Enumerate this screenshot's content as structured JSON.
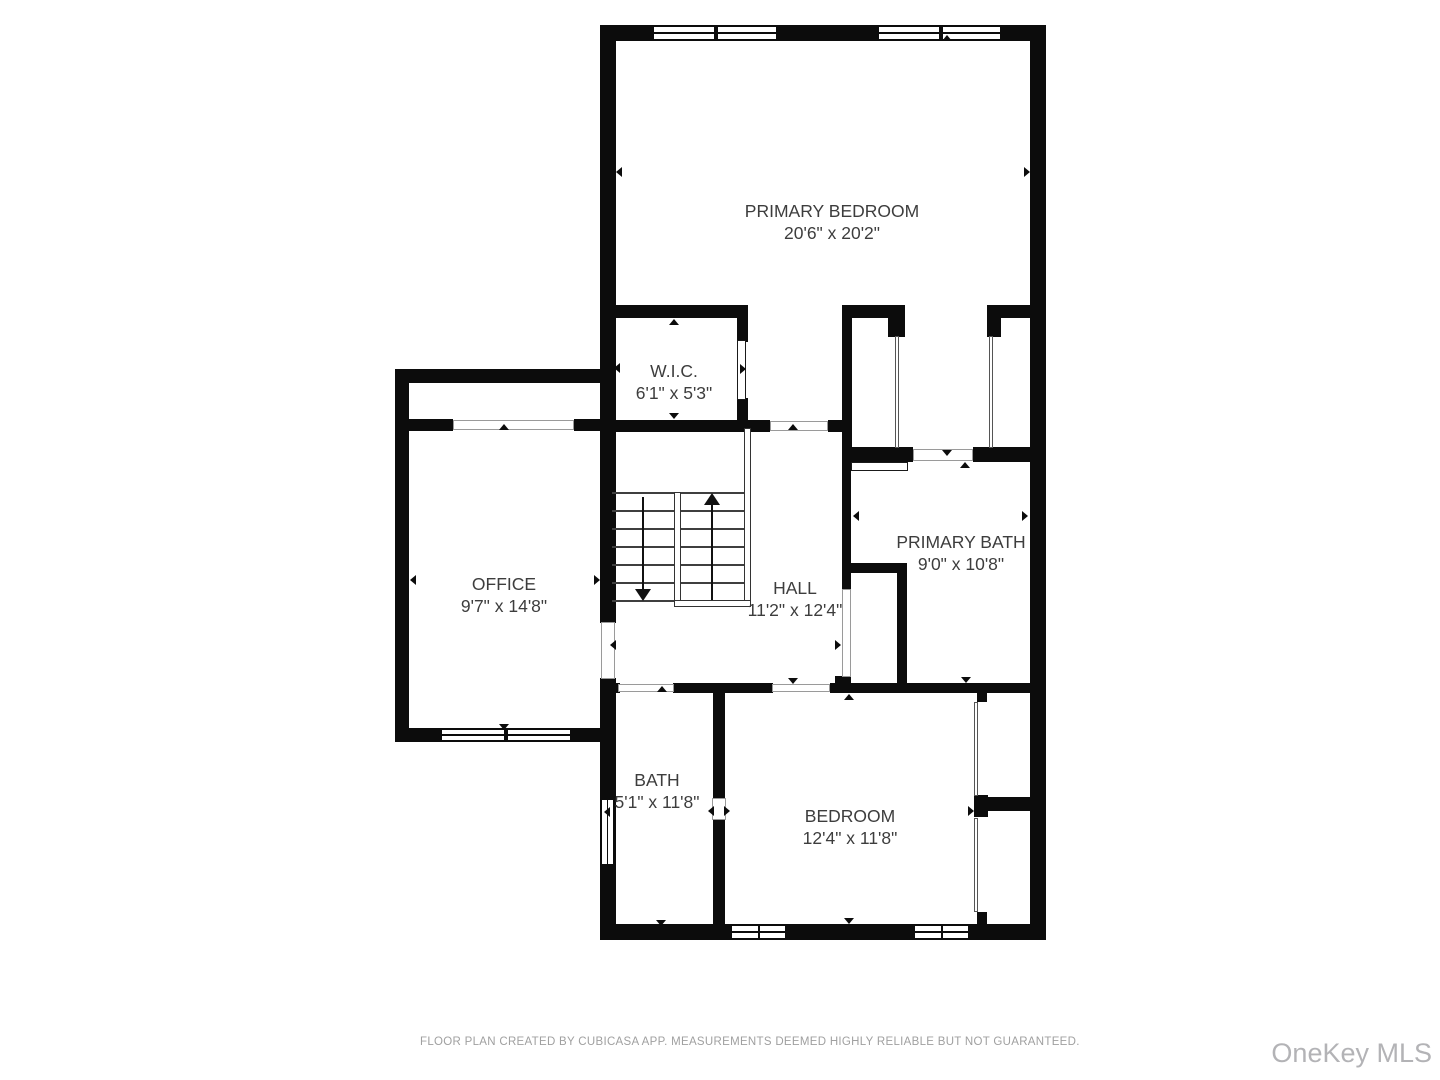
{
  "footer": {
    "text": "FLOOR PLAN CREATED BY CUBICASA APP. MEASUREMENTS DEEMED HIGHLY RELIABLE BUT NOT GUARANTEED."
  },
  "watermark": {
    "text": "OneKey MLS"
  },
  "colors": {
    "wall": "#0c0c0c",
    "label": "#3d3d3d",
    "muted_gray": "#a0a0a0",
    "watermark_gray": "#b3b3b6"
  },
  "rooms": [
    {
      "slug": "primary-bedroom",
      "name": "PRIMARY BEDROOM",
      "dims": "20'6\" x 20'2\"",
      "x": 832,
      "y": 222
    },
    {
      "slug": "wic",
      "name": "W.I.C.",
      "dims": "6'1\" x 5'3\"",
      "x": 674,
      "y": 382
    },
    {
      "slug": "office",
      "name": "OFFICE",
      "dims": "9'7\" x 14'8\"",
      "x": 504,
      "y": 595
    },
    {
      "slug": "hall",
      "name": "HALL",
      "dims": "11'2\" x 12'4\"",
      "x": 795,
      "y": 599
    },
    {
      "slug": "primary-bath",
      "name": "PRIMARY BATH",
      "dims": "9'0\" x 10'8\"",
      "x": 961,
      "y": 553
    },
    {
      "slug": "bath",
      "name": "BATH",
      "dims": "5'1\" x 11'8\"",
      "x": 657,
      "y": 791
    },
    {
      "slug": "bedroom",
      "name": "BEDROOM",
      "dims": "12'4\" x 11'8\"",
      "x": 850,
      "y": 827
    }
  ],
  "plan": {
    "walls": [
      [
        600,
        25,
        446,
        16
      ],
      [
        1030,
        25,
        16,
        915
      ],
      [
        600,
        924,
        446,
        16
      ],
      [
        600,
        25,
        16,
        598
      ],
      [
        600,
        678,
        16,
        262
      ],
      [
        395,
        369,
        221,
        14
      ],
      [
        395,
        369,
        14,
        373
      ],
      [
        395,
        728,
        221,
        14
      ],
      [
        409,
        419,
        44,
        12
      ],
      [
        574,
        419,
        30,
        12
      ],
      [
        600,
        305,
        148,
        13
      ],
      [
        843,
        305,
        62,
        13
      ],
      [
        987,
        305,
        59,
        13
      ],
      [
        888,
        318,
        17,
        19
      ],
      [
        987,
        318,
        14,
        19
      ],
      [
        842,
        305,
        10,
        157
      ],
      [
        843,
        447,
        70,
        15
      ],
      [
        973,
        447,
        73,
        15
      ],
      [
        737,
        305,
        11,
        37
      ],
      [
        737,
        398,
        11,
        34
      ],
      [
        600,
        420,
        170,
        12
      ],
      [
        828,
        420,
        24,
        12
      ],
      [
        842,
        462,
        9,
        127
      ],
      [
        835,
        676,
        16,
        17
      ],
      [
        850,
        563,
        57,
        10
      ],
      [
        897,
        563,
        10,
        130
      ],
      [
        600,
        683,
        20,
        10
      ],
      [
        673,
        683,
        100,
        10
      ],
      [
        830,
        683,
        216,
        10
      ],
      [
        713,
        692,
        12,
        106
      ],
      [
        713,
        820,
        12,
        104
      ],
      [
        977,
        692,
        10,
        10
      ],
      [
        974,
        795,
        14,
        22
      ],
      [
        977,
        797,
        69,
        14
      ],
      [
        977,
        912,
        10,
        12
      ]
    ],
    "openings": [
      [
        601,
        622,
        14,
        57
      ],
      [
        842,
        589,
        9,
        88
      ],
      [
        770,
        421,
        58,
        10
      ],
      [
        453,
        420,
        121,
        10
      ],
      [
        618,
        684,
        56,
        8
      ],
      [
        772,
        684,
        58,
        8
      ],
      [
        913,
        449,
        60,
        12
      ],
      [
        712,
        798,
        14,
        22
      ]
    ],
    "door_leaves": [
      [
        737,
        340,
        9,
        60
      ],
      [
        851,
        462,
        57,
        9
      ]
    ],
    "sliders": [
      [
        895,
        336,
        4,
        112
      ],
      [
        989,
        336,
        4,
        112
      ],
      [
        974,
        702,
        4,
        94
      ],
      [
        974,
        818,
        4,
        94
      ]
    ],
    "windows": [
      {
        "x": 652,
        "y": 25,
        "w": 64,
        "h": 16
      },
      {
        "x": 716,
        "y": 25,
        "w": 62,
        "h": 16
      },
      {
        "x": 877,
        "y": 25,
        "w": 64,
        "h": 16
      },
      {
        "x": 941,
        "y": 25,
        "w": 61,
        "h": 16
      },
      {
        "x": 440,
        "y": 728,
        "w": 66,
        "h": 14
      },
      {
        "x": 506,
        "y": 728,
        "w": 66,
        "h": 14
      },
      {
        "x": 730,
        "y": 924,
        "w": 57,
        "h": 16,
        "divider": true
      },
      {
        "x": 913,
        "y": 924,
        "w": 57,
        "h": 16,
        "divider": true
      },
      {
        "x": 600,
        "y": 798,
        "w": 15,
        "h": 68,
        "vertical": true
      }
    ],
    "markers": [
      {
        "x": 947,
        "y": 38,
        "d": "up"
      },
      {
        "x": 619,
        "y": 172,
        "d": "left"
      },
      {
        "x": 1027,
        "y": 172,
        "d": "right"
      },
      {
        "x": 947,
        "y": 453,
        "d": "down"
      },
      {
        "x": 674,
        "y": 322,
        "d": "up"
      },
      {
        "x": 617,
        "y": 368,
        "d": "left"
      },
      {
        "x": 743,
        "y": 369,
        "d": "right"
      },
      {
        "x": 674,
        "y": 416,
        "d": "down"
      },
      {
        "x": 504,
        "y": 427,
        "d": "up"
      },
      {
        "x": 413,
        "y": 580,
        "d": "left"
      },
      {
        "x": 597,
        "y": 580,
        "d": "right"
      },
      {
        "x": 504,
        "y": 727,
        "d": "down"
      },
      {
        "x": 793,
        "y": 427,
        "d": "up"
      },
      {
        "x": 613,
        "y": 645,
        "d": "left"
      },
      {
        "x": 838,
        "y": 645,
        "d": "right"
      },
      {
        "x": 793,
        "y": 681,
        "d": "down"
      },
      {
        "x": 965,
        "y": 465,
        "d": "up"
      },
      {
        "x": 856,
        "y": 516,
        "d": "left"
      },
      {
        "x": 1025,
        "y": 516,
        "d": "right"
      },
      {
        "x": 966,
        "y": 680,
        "d": "down"
      },
      {
        "x": 662,
        "y": 689,
        "d": "up"
      },
      {
        "x": 607,
        "y": 812,
        "d": "left"
      },
      {
        "x": 711,
        "y": 811,
        "d": "left"
      },
      {
        "x": 727,
        "y": 811,
        "d": "right"
      },
      {
        "x": 661,
        "y": 923,
        "d": "down"
      },
      {
        "x": 849,
        "y": 697,
        "d": "up"
      },
      {
        "x": 971,
        "y": 811,
        "d": "right"
      },
      {
        "x": 849,
        "y": 921,
        "d": "down"
      }
    ],
    "stairs": {
      "treads": [
        [
          612,
          492,
          62
        ],
        [
          612,
          510,
          62
        ],
        [
          612,
          528,
          62
        ],
        [
          612,
          546,
          62
        ],
        [
          612,
          564,
          62
        ],
        [
          612,
          582,
          62
        ],
        [
          612,
          600,
          62
        ],
        [
          681,
          492,
          63
        ],
        [
          681,
          510,
          63
        ],
        [
          681,
          528,
          63
        ],
        [
          681,
          546,
          63
        ],
        [
          681,
          564,
          63
        ],
        [
          681,
          582,
          63
        ],
        [
          681,
          600,
          63
        ]
      ],
      "railings": [
        [
          744,
          428,
          7,
          179
        ],
        [
          674,
          492,
          7,
          115
        ],
        [
          674,
          600,
          77,
          7
        ]
      ],
      "arrows": [
        {
          "x": 643,
          "y1": 497,
          "y2": 589,
          "head": "down"
        },
        {
          "x": 712,
          "y1": 505,
          "y2": 600,
          "head": "up"
        }
      ]
    }
  }
}
